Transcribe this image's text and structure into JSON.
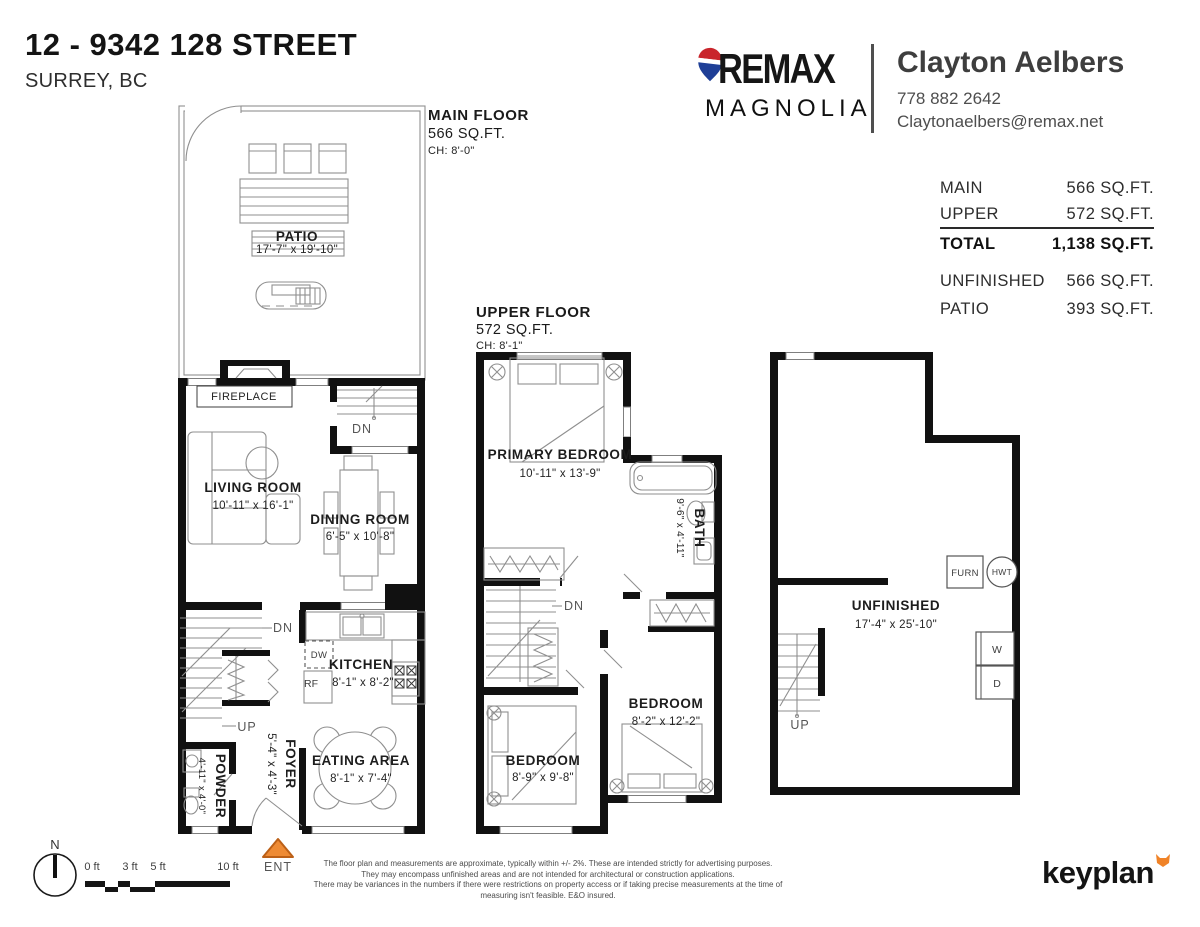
{
  "header": {
    "address_line1": "12 - 9342 128 STREET",
    "address_line2": "SURREY, BC",
    "brokerage": {
      "brand": "REMAX",
      "office": "MAGNOLIA"
    },
    "agent": {
      "name": "Clayton Aelbers",
      "phone": "778 882 2642",
      "email": "Claytonaelbers@remax.net"
    }
  },
  "area_summary": {
    "rows": [
      {
        "label": "MAIN",
        "value": "566 SQ.FT."
      },
      {
        "label": "UPPER",
        "value": "572 SQ.FT."
      },
      {
        "label": "TOTAL",
        "value": "1,138 SQ.FT."
      },
      {
        "label": "UNFINISHED",
        "value": "566 SQ.FT."
      },
      {
        "label": "PATIO",
        "value": "393 SQ.FT."
      }
    ]
  },
  "main_floor": {
    "title": "MAIN FLOOR",
    "area": "566 SQ.FT.",
    "ceiling_height": "CH: 8'-0\"",
    "patio": {
      "name": "PATIO",
      "dims": "17'-7\" x 19'-10\""
    },
    "fireplace_label": "FIREPLACE",
    "living_room": {
      "name": "LIVING ROOM",
      "dims": "10'-11\" x 16'-1\""
    },
    "dining_room": {
      "name": "DINING ROOM",
      "dims": "6'-5\" x 10'-8\""
    },
    "kitchen": {
      "name": "KITCHEN",
      "dims": "8'-1\" x 8'-2\""
    },
    "eating_area": {
      "name": "EATING AREA",
      "dims": "8'-1\" x 7'-4\""
    },
    "foyer": {
      "name": "FOYER",
      "dims": "5'-4\" x 4'-3\""
    },
    "powder": {
      "name": "POWDER",
      "dims": "4'-11\" x 4'-0\""
    }
  },
  "upper_floor": {
    "title": "UPPER FLOOR",
    "area": "572 SQ.FT.",
    "ceiling_height": "CH: 8'-1\"",
    "primary_bedroom": {
      "name": "PRIMARY BEDROOM",
      "dims": "10'-11\" x 13'-9\""
    },
    "bath": {
      "name": "BATH",
      "dims": "9'-6\" x 4'-11\""
    },
    "bedroom_left": {
      "name": "BEDROOM",
      "dims": "8'-9\" x 9'-8\""
    },
    "bedroom_right": {
      "name": "BEDROOM",
      "dims": "8'-2\" x 12'-2\""
    }
  },
  "basement": {
    "unfinished": {
      "name": "UNFINISHED",
      "dims": "17'-4\" x 25'-10\""
    }
  },
  "markers": {
    "down": "DN",
    "up": "UP",
    "entry": "ENT",
    "north": "N"
  },
  "appliances": {
    "dishwasher": "DW",
    "refrigerator": "RF",
    "furnace": "FURN",
    "hot_water_tank": "HWT",
    "washer": "W",
    "dryer": "D"
  },
  "scale_bar": {
    "labels": [
      "0 ft",
      "3 ft",
      "5 ft",
      "10 ft"
    ]
  },
  "colors": {
    "entry_marker": "#ee8b35",
    "balloon_red": "#c9252c",
    "balloon_blue": "#1f3f97",
    "fox_orange": "#f08328"
  },
  "footer": {
    "disclaimer_lines": [
      "The floor plan and measurements are approximate, typically within +/- 2%. These are intended strictly for advertising purposes.",
      "They may encompass unfinished areas and are not intended for architectural or construction applications.",
      "There may be variances in the numbers if there were restrictions on property access or if taking precise measurements at the time of measuring isn't feasible. E&O insured."
    ],
    "brand": "keyplan"
  }
}
